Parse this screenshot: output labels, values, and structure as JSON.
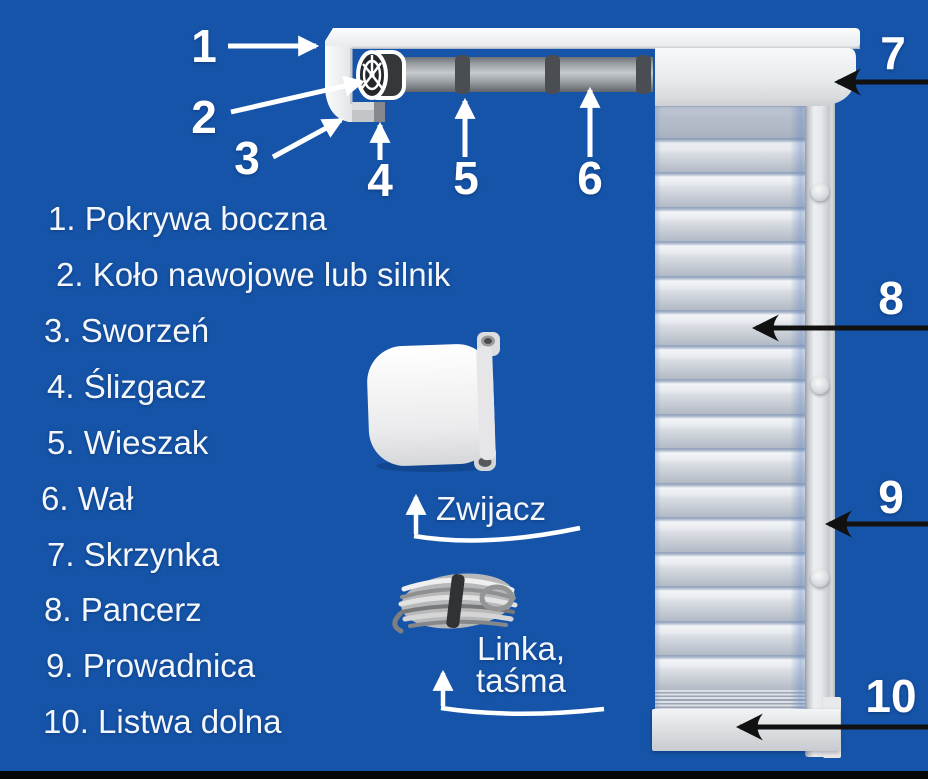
{
  "diagram": {
    "subject": "roller-shutter-parts",
    "parts_list": [
      {
        "number": "1.",
        "name": "Pokrywa boczna"
      },
      {
        "number": "2.",
        "name": "Koło nawojowe lub silnik"
      },
      {
        "number": "3.",
        "name": "Sworzeń"
      },
      {
        "number": "4.",
        "name": "Ślizgacz"
      },
      {
        "number": "5.",
        "name": "Wieszak"
      },
      {
        "number": "6.",
        "name": "Wał"
      },
      {
        "number": "7.",
        "name": "Skrzynka"
      },
      {
        "number": "8.",
        "name": "Pancerz"
      },
      {
        "number": "9.",
        "name": "Prowadnica"
      },
      {
        "number": "10.",
        "name": "Listwa dolna"
      }
    ],
    "callouts": {
      "c1": "1",
      "c2": "2",
      "c3": "3",
      "c4": "4",
      "c5": "5",
      "c6": "6",
      "c7": "7",
      "c8": "8",
      "c9": "9",
      "c10": "10"
    },
    "labels": {
      "zwijacz": "Zwijacz",
      "linka_line1": "Linka,",
      "linka_line2": "taśma"
    },
    "colors": {
      "background": "#1554a8",
      "text": "#f3f6fa",
      "white_arrows": "#ffffff",
      "black_arrows": "#111111"
    }
  }
}
